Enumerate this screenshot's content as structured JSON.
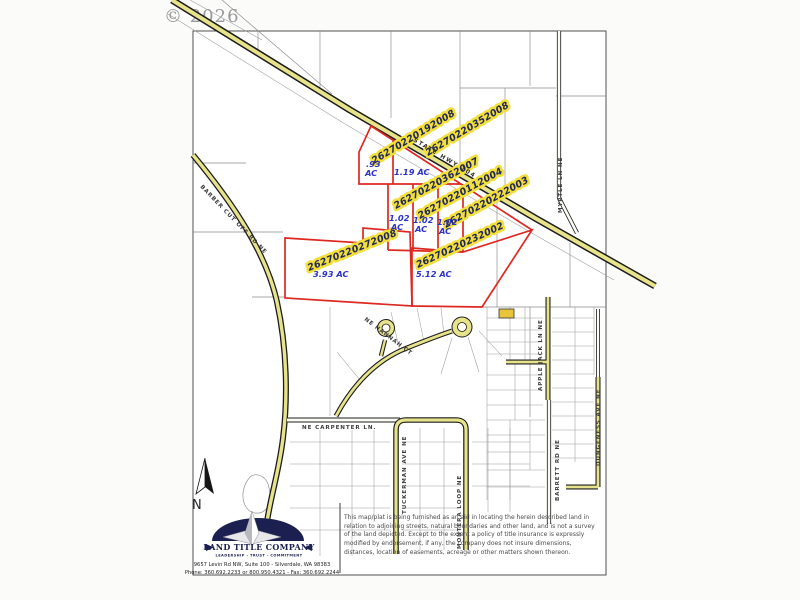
{
  "watermark": "© 2026",
  "map": {
    "highway_label": "STATE HWY 104",
    "north_label": "N",
    "parcel_numbers": [
      "26270220192008",
      "26270220352008",
      "26270220362007",
      "26270220112004",
      "26270220222003",
      "26270220272008",
      "26270220232002"
    ],
    "acreages": [
      ".93",
      "AC",
      "1.19 AC",
      "1.02",
      "AC",
      "1.02",
      "AC",
      "1.02",
      "AC",
      "3.93 AC",
      "5.12 AC"
    ],
    "streets": {
      "barber": "BARBER CUT OFF RD NE",
      "myrtle": "MYRTLE LN NE",
      "hannah": "NE HANNAH CT",
      "carpenter": "NE CARPENTER LN.",
      "tuckerman": "TUCKERMAN AVE NE",
      "montera": "MONTERA LOOP NE",
      "applejack": "APPLE JACK LN NE",
      "barrett": "BARRETT RD NE",
      "dungeness": "DUNGENESS AVE NE"
    }
  },
  "footer": {
    "logo_name": "LAND TITLE COMPANY",
    "logo_tagline": "LEADERSHIP - TRUST - COMMITMENT",
    "address": "9657 Levin Rd NW, Suite 100 - Silverdale, WA 98383",
    "phone": "Phone: 360.692.2233 or 800.950.4321 - Fax: 360.692.2244",
    "disclaimer": "This map/plat is being furnished as an aid in locating the herein described land in relation to adjoining streets, natural boundaries and other land, and is not a survey of the land depicted. Except to the extent a policy of title insurance is expressly modified by endorsement, if any, the company does not insure dimensions, distances, location of easements, acreage or other matters shown thereon."
  },
  "colors": {
    "parcel_outline_red": "#dd2822",
    "road_yellow": "#e7e38a",
    "label_highlight_yellow": "#f2df3a",
    "annotation_blue": "#2b32c8",
    "logo_navy": "#1b2050"
  }
}
